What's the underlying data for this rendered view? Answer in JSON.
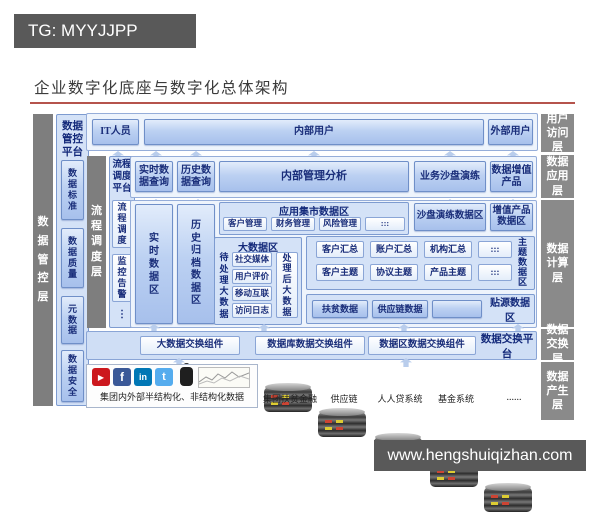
{
  "watermark": {
    "tg_label": "TG: MYYJJPP",
    "site_label": "www.hengshuiqizhan.com"
  },
  "title": "企业数字化底座与数字化总体架构",
  "layer_labels": [
    "用户访问层",
    "数据应用层",
    "数据计算层",
    "数据交换层",
    "数据产生层"
  ],
  "governance": {
    "layer": "数据管控层",
    "platform_title": "数据管控平台",
    "items": [
      "数据标准",
      "数据质量",
      "元数据",
      "数据安全"
    ]
  },
  "scheduling": {
    "layer": "流程调度层",
    "platform_title": "流程调度平台",
    "items": [
      "流程调度",
      "监控告警",
      "⋮"
    ]
  },
  "access_layer": {
    "it_user": "IT人员",
    "internal_user": "内部用户",
    "external_user": "外部用户"
  },
  "app_layer": {
    "realtime_query": "实时数据查询",
    "history_query": "历史数据查询",
    "mgmt_analysis": "内部管理分析",
    "sandbox": "业务沙盘演练",
    "value_product": "数据增值产品"
  },
  "compute_layer": {
    "realtime_area": "实时数据区",
    "archive_area": "历史归档数据区",
    "app_mart": {
      "title": "应用集市数据区",
      "items": [
        "客户管理",
        "财务管理",
        "风险管理",
        ":::"
      ]
    },
    "sandbox_area_title": "沙盘演练数据区",
    "value_area_title": "增值产品数据区",
    "bigdata": {
      "title": "大数据区",
      "pending": "待处理大数据",
      "items": [
        "社交媒体",
        "用户评价",
        "移动互联",
        "访问日志"
      ],
      "processed": "处理后大数据"
    },
    "theme": {
      "label": "主题数据区",
      "row1": [
        "客户汇总",
        "账户汇总",
        "机构汇总",
        ":::"
      ],
      "row2": [
        "客户主题",
        "协议主题",
        "产品主题",
        ":::"
      ]
    },
    "source": {
      "label": "贴源数据区",
      "items": [
        "扶贫数据",
        "供应链数据"
      ]
    }
  },
  "exchange_layer": {
    "components": [
      "大数据交换组件",
      "数据库数据交换组件",
      "数据区数据交换组件"
    ],
    "platform": "数据交换平台"
  },
  "produce_layer": {
    "caption": "集团内外部半结构化、非结构化数据",
    "icon_glyphs": {
      "youtube": "▶",
      "facebook": "f",
      "linkedin": "in",
      "twitter": "t"
    },
    "databases": [
      "集团扶贫金融",
      "供应链",
      "人人贷系统",
      "基金系统"
    ],
    "more": "......"
  }
}
